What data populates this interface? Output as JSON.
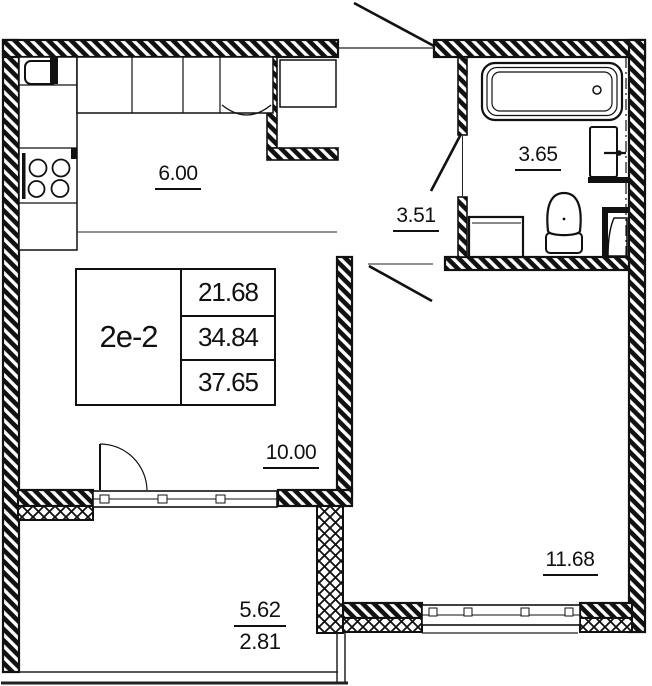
{
  "colors": {
    "ink": "#111111",
    "background": "#ffffff"
  },
  "unit_table": {
    "unit_id": "2е-2",
    "area_living": "21.68",
    "area_total": "34.84",
    "area_total_with_balcony": "37.65"
  },
  "rooms": {
    "kitchen": "6.00",
    "bathroom": "3.65",
    "hallway": "3.51",
    "living": "10.00",
    "bedroom": "11.68",
    "balcony_full": "5.62",
    "balcony_reduced": "2.81"
  }
}
